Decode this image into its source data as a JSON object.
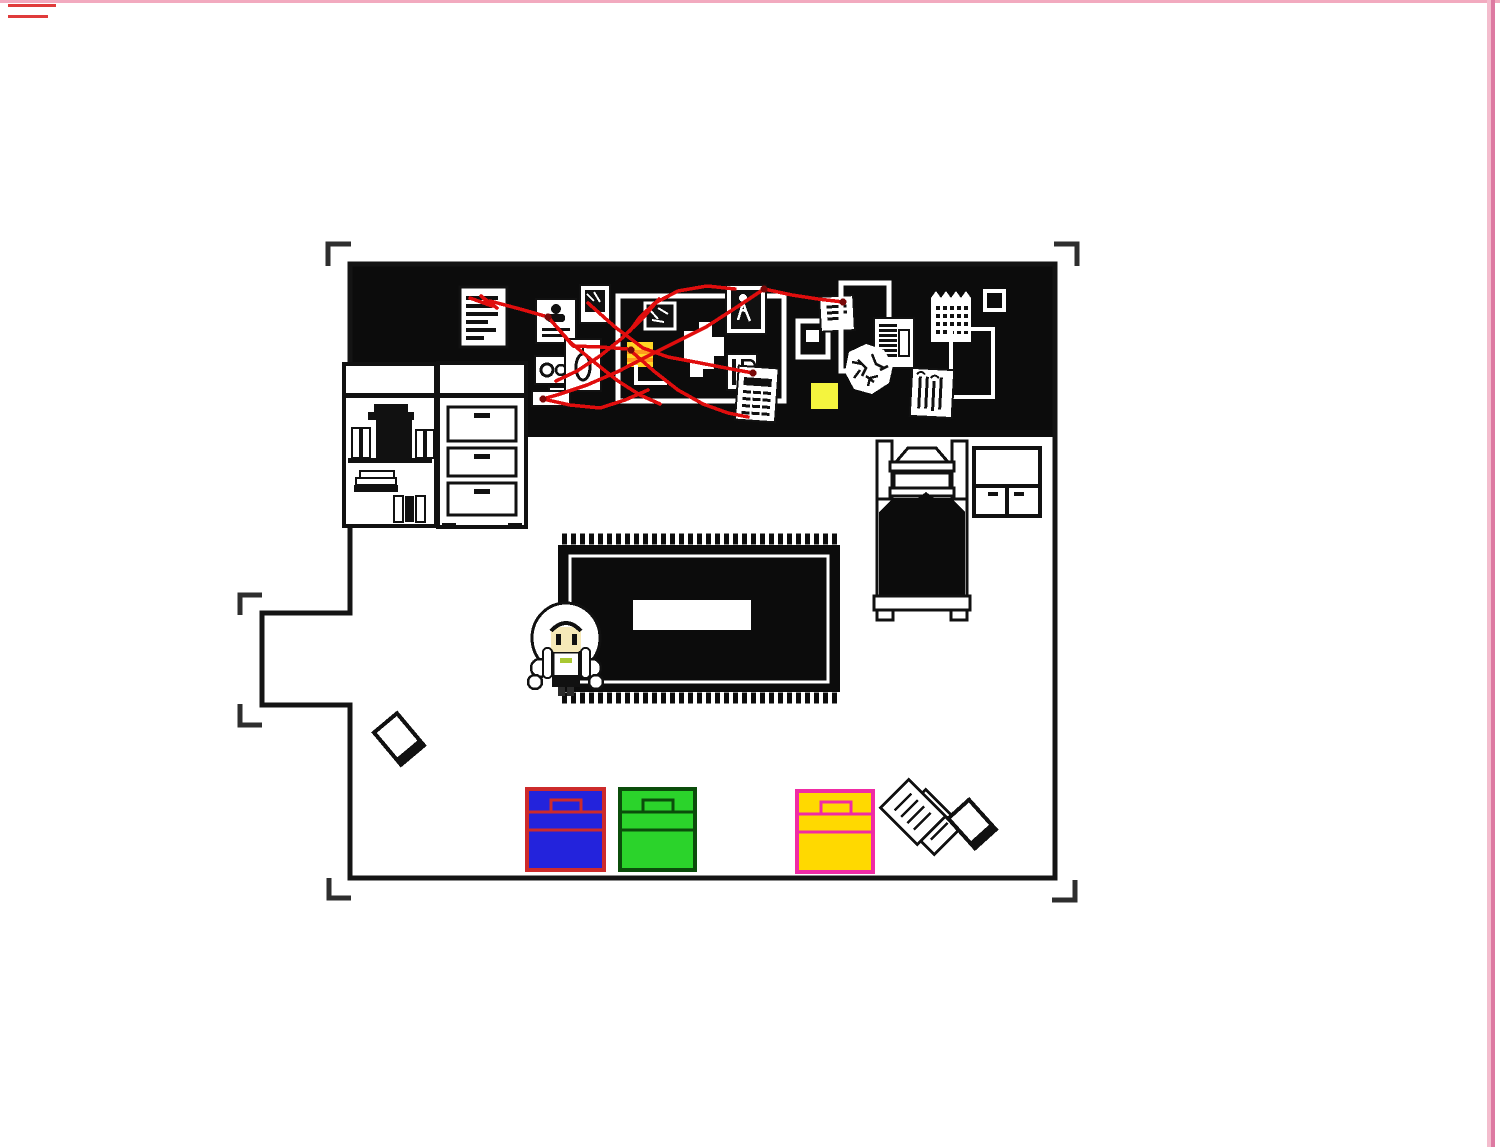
{
  "scene": {
    "description": "top-down pixel-art bedroom with detective evidence board",
    "objects": {
      "evidence_board_items": [
        "lined-document",
        "suspect-card",
        "small-photo",
        "eye-card",
        "seed-card",
        "paper-tab",
        "large-frame",
        "crossed-photo",
        "sticky-note",
        "map-scrap",
        "walking-person-photo",
        "ip-paper",
        "receipt",
        "small-frame",
        "lined-note",
        "tall-frame",
        "dense-document",
        "crumpled-paper",
        "sticky-square",
        "calendar",
        "tiny-frame",
        "right-frame",
        "tally-paper"
      ],
      "furniture": [
        "bookshelf",
        "dresser",
        "bed",
        "nightstand",
        "rug"
      ],
      "floor_items": [
        "book",
        "blue-chest",
        "green-chest",
        "yellow-chest",
        "scattered-papers",
        "book"
      ],
      "character": "white-haired pixel girl"
    }
  },
  "colors": {
    "background": "#ffffff",
    "wall_black": "#0c0c0c",
    "outline_black": "#141414",
    "item_ink": "#111111",
    "paper_white": "#ffffff",
    "bracket_gray": "#2e2e2e",
    "border_pink_light": "#f4bccd",
    "border_pink": "#dd7aa2",
    "top_line_pink": "#f2aabf",
    "dash_red": "#e03b3b",
    "string_red": "#e00d0d",
    "pin_red": "#7a0909",
    "sticky_yellow_bright": "#f4f43e",
    "note_yellow": "#ffd825",
    "note_orange": "#ff9a1e",
    "chest_blue_fill": "#2323dc",
    "chest_blue_outline": "#cd2b2b",
    "chest_green_fill": "#2bd32b",
    "chest_green_outline": "#0b4d0b",
    "chest_yellow_fill": "#ffd900",
    "chest_yellow_outline": "#f02ba5",
    "character_skin": "#f6e9b8",
    "character_collar": "#a9c832"
  }
}
